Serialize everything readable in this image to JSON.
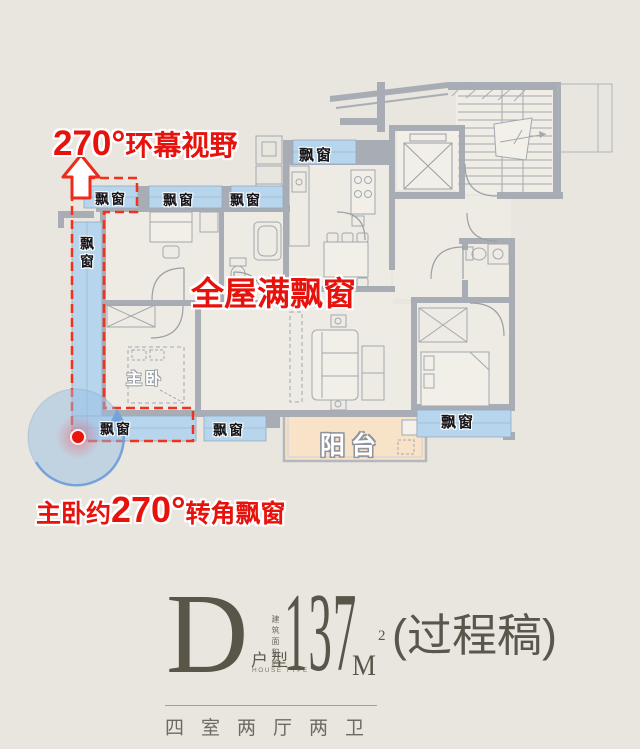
{
  "annotations": {
    "surround_view": {
      "degree": "270°",
      "label": "环幕视野"
    },
    "full_bay_windows": "全屋满飘窗",
    "corner_bay": {
      "prefix": "主卧约",
      "degree": "270°",
      "suffix": "转角飘窗"
    }
  },
  "plan": {
    "bay_window_label": "飘窗",
    "master_bedroom": "主卧",
    "balcony": "阳台"
  },
  "title_block": {
    "plan_letter": "D",
    "type_cn": "户型",
    "type_en": "HOUSE TYPE",
    "area_prefix": "建筑面积约",
    "area_value": "137",
    "area_unit": "M",
    "area_power": "2",
    "stage_note": "(过程稿)",
    "layout_summary": "四室两厅两卫"
  },
  "colors": {
    "accent_red": "#e8120c",
    "bay_window_blue": "#b7d6ee",
    "balcony_peach": "#f8e3c9",
    "wall_gray": "#a8adb5",
    "background": "#e9e6df"
  }
}
